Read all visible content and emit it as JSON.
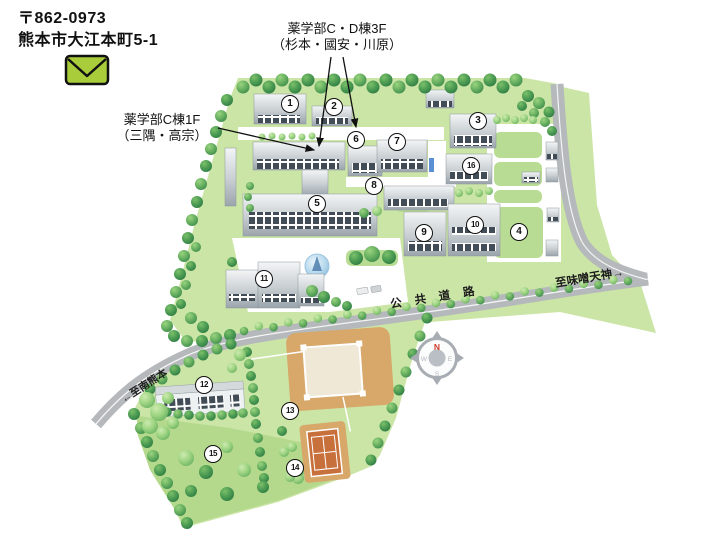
{
  "address": {
    "postal_code": "〒862-0973",
    "address_line": "熊本市大江本町5-1"
  },
  "annotations": {
    "cd_bldg_3f": {
      "line1": "薬学部C・D棟3F",
      "line2": "（杉本・國安・川原）"
    },
    "c_bldg_1f": {
      "line1": "薬学部C棟1F",
      "line2": "（三隅・高宗）"
    }
  },
  "road_labels": {
    "public_road": "公共道路",
    "to_misotenjin": "至味噌天神→",
    "to_minami_kumamoto": "←至南熊本"
  },
  "compass": {
    "north": "N",
    "east": "E",
    "south": "S",
    "west": "W"
  },
  "building_markers": [
    {
      "no": "1",
      "x": 290,
      "y": 104
    },
    {
      "no": "2",
      "x": 334,
      "y": 107
    },
    {
      "no": "3",
      "x": 478,
      "y": 121
    },
    {
      "no": "4",
      "x": 519,
      "y": 232
    },
    {
      "no": "5",
      "x": 317,
      "y": 204
    },
    {
      "no": "6",
      "x": 356,
      "y": 140
    },
    {
      "no": "7",
      "x": 397,
      "y": 142
    },
    {
      "no": "8",
      "x": 374,
      "y": 186
    },
    {
      "no": "9",
      "x": 424,
      "y": 233
    },
    {
      "no": "10",
      "x": 475,
      "y": 225
    },
    {
      "no": "11",
      "x": 264,
      "y": 279
    },
    {
      "no": "12",
      "x": 204,
      "y": 385
    },
    {
      "no": "13",
      "x": 290,
      "y": 411
    },
    {
      "no": "14",
      "x": 295,
      "y": 468
    },
    {
      "no": "15",
      "x": 213,
      "y": 454
    },
    {
      "no": "16",
      "x": 471,
      "y": 166
    }
  ],
  "icons": {
    "envelope": "envelope-icon",
    "compass": "compass-rose-icon"
  },
  "colors": {
    "campus_green": "#cbe5a6",
    "area15_green": "#b4d98c",
    "tree_green": "#2f7f44",
    "road_gray": "#b5b9bb",
    "field_tan": "#d7a869",
    "tennis_orange": "#c8703c",
    "building_gray": "#aab3ba",
    "envelope_green": "#a8cc3a",
    "north_red": "#d03a2a",
    "water_blue": "#7fb0d6"
  }
}
